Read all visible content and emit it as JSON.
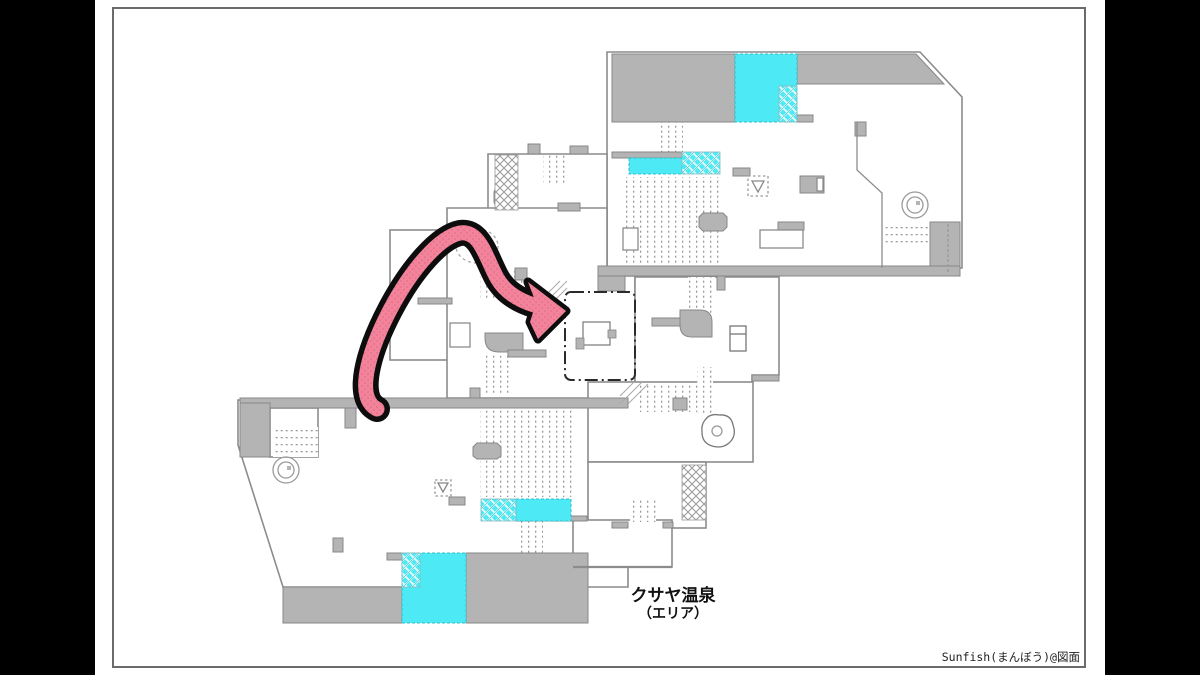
{
  "title": {
    "line1": "クサヤ温泉",
    "line2": "（エリア）"
  },
  "credit": "Sunfish(まんぼう)@図面",
  "colors": {
    "letterbox": "#000000",
    "sheet": "#ffffff",
    "outline_gray": "#8c8c8c",
    "roof_gray": "#b4b4b4",
    "water_cyan": "#4de9f4",
    "arrow_pink": "#f2839a",
    "arrow_outline": "#0d0d0d",
    "highlight_stroke": "#2a2a2a"
  },
  "map": {
    "name": "kusaya-onsen-area-floor-plan",
    "annotation": {
      "type": "route-arrow",
      "color": "#f2839a",
      "from": "lower-left-walkway",
      "to": "dash-dot-highlighted-room"
    },
    "features": [
      "roof-blocks-gray",
      "bath-pools-cyan",
      "crosshatch-bath-edges",
      "dotted-stair-fields",
      "spiral-drain-icons",
      "bathtub-octagon-icons",
      "rock-icons",
      "shower-icons",
      "highlighted-room-dashdot-box"
    ]
  }
}
